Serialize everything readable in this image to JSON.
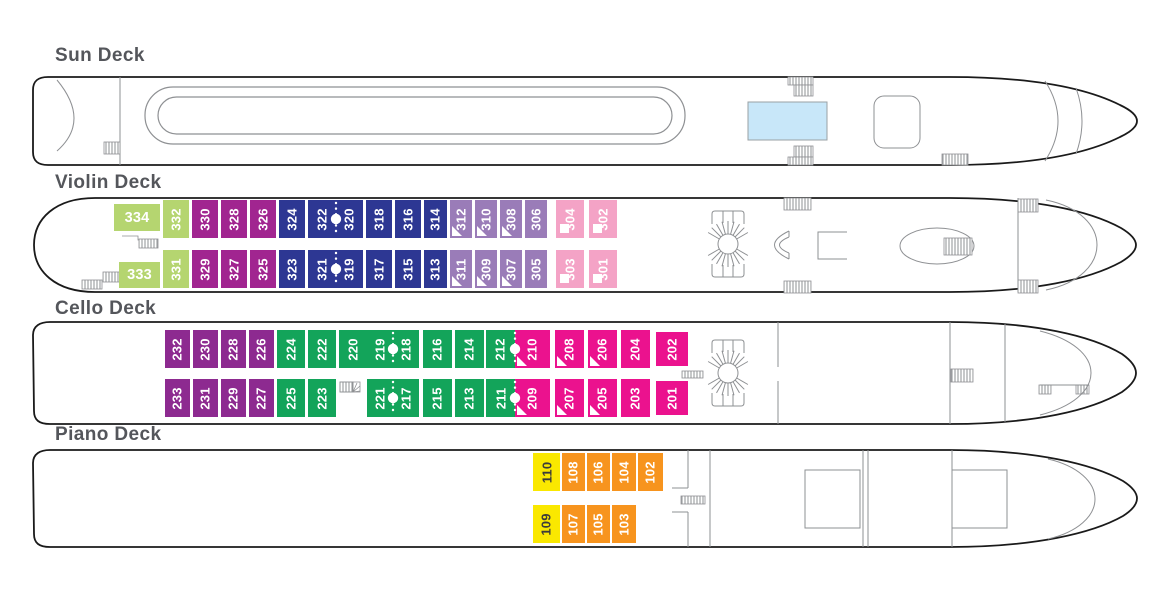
{
  "decks": [
    {
      "id": "sun",
      "title": "Sun Deck",
      "cabins": []
    },
    {
      "id": "violin",
      "title": "Violin Deck",
      "cabins": [
        {
          "num": "334",
          "x": 114,
          "y": 204,
          "w": 46,
          "h": 27,
          "color": "lightgreen",
          "icon": null,
          "orient": "h"
        },
        {
          "num": "332",
          "x": 163,
          "y": 200,
          "w": 26,
          "h": 38,
          "color": "lightgreen",
          "icon": null,
          "orient": "v"
        },
        {
          "num": "330",
          "x": 192,
          "y": 200,
          "w": 26,
          "h": 38,
          "color": "magenta",
          "icon": null,
          "orient": "v"
        },
        {
          "num": "328",
          "x": 221,
          "y": 200,
          "w": 26,
          "h": 38,
          "color": "magenta",
          "icon": null,
          "orient": "v"
        },
        {
          "num": "326",
          "x": 250,
          "y": 200,
          "w": 26,
          "h": 38,
          "color": "magenta",
          "icon": null,
          "orient": "v"
        },
        {
          "num": "324",
          "x": 279,
          "y": 200,
          "w": 26,
          "h": 38,
          "color": "navy",
          "icon": null,
          "orient": "v"
        },
        {
          "num": "322",
          "x": 308,
          "y": 200,
          "w": 28,
          "h": 38,
          "color": "navy",
          "icon": null,
          "orient": "v"
        },
        {
          "num": "320",
          "x": 336,
          "y": 200,
          "w": 27,
          "h": 38,
          "color": "navy",
          "icon": null,
          "orient": "v"
        },
        {
          "num": "318",
          "x": 366,
          "y": 200,
          "w": 26,
          "h": 38,
          "color": "navy",
          "icon": null,
          "orient": "v"
        },
        {
          "num": "316",
          "x": 395,
          "y": 200,
          "w": 26,
          "h": 38,
          "color": "navy",
          "icon": null,
          "orient": "v"
        },
        {
          "num": "314",
          "x": 424,
          "y": 200,
          "w": 23,
          "h": 38,
          "color": "navy",
          "icon": null,
          "orient": "v"
        },
        {
          "num": "312",
          "x": 450,
          "y": 200,
          "w": 22,
          "h": 38,
          "color": "lavender",
          "icon": "triangle",
          "orient": "v"
        },
        {
          "num": "310",
          "x": 475,
          "y": 200,
          "w": 22,
          "h": 38,
          "color": "lavender",
          "icon": "triangle",
          "orient": "v"
        },
        {
          "num": "308",
          "x": 500,
          "y": 200,
          "w": 22,
          "h": 38,
          "color": "lavender",
          "icon": "triangle",
          "orient": "v"
        },
        {
          "num": "306",
          "x": 525,
          "y": 200,
          "w": 22,
          "h": 38,
          "color": "lavender",
          "icon": null,
          "orient": "v"
        },
        {
          "num": "304",
          "x": 556,
          "y": 200,
          "w": 28,
          "h": 38,
          "color": "lightpink",
          "icon": "square",
          "orient": "v"
        },
        {
          "num": "302",
          "x": 589,
          "y": 200,
          "w": 28,
          "h": 38,
          "color": "lightpink",
          "icon": "square",
          "orient": "v"
        },
        {
          "num": "333",
          "x": 119,
          "y": 262,
          "w": 41,
          "h": 26,
          "color": "lightgreen",
          "icon": null,
          "orient": "h"
        },
        {
          "num": "331",
          "x": 163,
          "y": 250,
          "w": 26,
          "h": 38,
          "color": "lightgreen",
          "icon": null,
          "orient": "v"
        },
        {
          "num": "329",
          "x": 192,
          "y": 250,
          "w": 26,
          "h": 38,
          "color": "magenta",
          "icon": null,
          "orient": "v"
        },
        {
          "num": "327",
          "x": 221,
          "y": 250,
          "w": 26,
          "h": 38,
          "color": "magenta",
          "icon": null,
          "orient": "v"
        },
        {
          "num": "325",
          "x": 250,
          "y": 250,
          "w": 26,
          "h": 38,
          "color": "magenta",
          "icon": null,
          "orient": "v"
        },
        {
          "num": "323",
          "x": 279,
          "y": 250,
          "w": 26,
          "h": 38,
          "color": "navy",
          "icon": null,
          "orient": "v"
        },
        {
          "num": "321",
          "x": 308,
          "y": 250,
          "w": 28,
          "h": 38,
          "color": "navy",
          "icon": null,
          "orient": "v"
        },
        {
          "num": "319",
          "x": 336,
          "y": 250,
          "w": 27,
          "h": 38,
          "color": "navy",
          "icon": null,
          "orient": "v"
        },
        {
          "num": "317",
          "x": 366,
          "y": 250,
          "w": 26,
          "h": 38,
          "color": "navy",
          "icon": null,
          "orient": "v"
        },
        {
          "num": "315",
          "x": 395,
          "y": 250,
          "w": 26,
          "h": 38,
          "color": "navy",
          "icon": null,
          "orient": "v"
        },
        {
          "num": "313",
          "x": 424,
          "y": 250,
          "w": 23,
          "h": 38,
          "color": "navy",
          "icon": null,
          "orient": "v"
        },
        {
          "num": "311",
          "x": 450,
          "y": 250,
          "w": 22,
          "h": 38,
          "color": "lavender",
          "icon": "triangle",
          "orient": "v"
        },
        {
          "num": "309",
          "x": 475,
          "y": 250,
          "w": 22,
          "h": 38,
          "color": "lavender",
          "icon": "triangle",
          "orient": "v"
        },
        {
          "num": "307",
          "x": 500,
          "y": 250,
          "w": 22,
          "h": 38,
          "color": "lavender",
          "icon": "triangle",
          "orient": "v"
        },
        {
          "num": "305",
          "x": 525,
          "y": 250,
          "w": 22,
          "h": 38,
          "color": "lavender",
          "icon": null,
          "orient": "v"
        },
        {
          "num": "303",
          "x": 556,
          "y": 250,
          "w": 28,
          "h": 38,
          "color": "lightpink",
          "icon": "square",
          "orient": "v"
        },
        {
          "num": "301",
          "x": 589,
          "y": 250,
          "w": 28,
          "h": 38,
          "color": "lightpink",
          "icon": "square",
          "orient": "v"
        }
      ]
    },
    {
      "id": "cello",
      "title": "Cello Deck",
      "cabins": [
        {
          "num": "232",
          "x": 165,
          "y": 330,
          "w": 25,
          "h": 38,
          "color": "plum",
          "icon": null,
          "orient": "v"
        },
        {
          "num": "230",
          "x": 193,
          "y": 330,
          "w": 25,
          "h": 38,
          "color": "plum",
          "icon": null,
          "orient": "v"
        },
        {
          "num": "228",
          "x": 221,
          "y": 330,
          "w": 25,
          "h": 38,
          "color": "plum",
          "icon": null,
          "orient": "v"
        },
        {
          "num": "226",
          "x": 249,
          "y": 330,
          "w": 25,
          "h": 38,
          "color": "plum",
          "icon": null,
          "orient": "v"
        },
        {
          "num": "224",
          "x": 277,
          "y": 330,
          "w": 28,
          "h": 38,
          "color": "green",
          "icon": null,
          "orient": "v"
        },
        {
          "num": "222",
          "x": 308,
          "y": 330,
          "w": 28,
          "h": 38,
          "color": "green",
          "icon": null,
          "orient": "v"
        },
        {
          "num": "220",
          "x": 339,
          "y": 330,
          "w": 28,
          "h": 38,
          "color": "green",
          "icon": null,
          "orient": "v"
        },
        {
          "num": "219",
          "x": 367,
          "y": 330,
          "w": 26,
          "h": 38,
          "color": "green",
          "icon": null,
          "orient": "v"
        },
        {
          "num": "218",
          "x": 393,
          "y": 330,
          "w": 26,
          "h": 38,
          "color": "green",
          "icon": null,
          "orient": "v"
        },
        {
          "num": "216",
          "x": 423,
          "y": 330,
          "w": 29,
          "h": 38,
          "color": "green",
          "icon": null,
          "orient": "v"
        },
        {
          "num": "214",
          "x": 455,
          "y": 330,
          "w": 29,
          "h": 38,
          "color": "green",
          "icon": null,
          "orient": "v"
        },
        {
          "num": "212",
          "x": 486,
          "y": 330,
          "w": 29,
          "h": 38,
          "color": "green",
          "icon": null,
          "orient": "v"
        },
        {
          "num": "210",
          "x": 515,
          "y": 330,
          "w": 35,
          "h": 38,
          "color": "hotpink",
          "icon": "triangle",
          "orient": "v"
        },
        {
          "num": "208",
          "x": 555,
          "y": 330,
          "w": 29,
          "h": 38,
          "color": "hotpink",
          "icon": "triangle",
          "orient": "v"
        },
        {
          "num": "206",
          "x": 588,
          "y": 330,
          "w": 29,
          "h": 38,
          "color": "hotpink",
          "icon": "triangle",
          "orient": "v"
        },
        {
          "num": "204",
          "x": 621,
          "y": 330,
          "w": 29,
          "h": 38,
          "color": "hotpink",
          "icon": null,
          "orient": "v"
        },
        {
          "num": "202",
          "x": 656,
          "y": 332,
          "w": 32,
          "h": 34,
          "color": "hotpink",
          "icon": null,
          "orient": "v"
        },
        {
          "num": "233",
          "x": 165,
          "y": 379,
          "w": 25,
          "h": 38,
          "color": "plum",
          "icon": null,
          "orient": "v"
        },
        {
          "num": "231",
          "x": 193,
          "y": 379,
          "w": 25,
          "h": 38,
          "color": "plum",
          "icon": null,
          "orient": "v"
        },
        {
          "num": "229",
          "x": 221,
          "y": 379,
          "w": 25,
          "h": 38,
          "color": "plum",
          "icon": null,
          "orient": "v"
        },
        {
          "num": "227",
          "x": 249,
          "y": 379,
          "w": 25,
          "h": 38,
          "color": "plum",
          "icon": null,
          "orient": "v"
        },
        {
          "num": "225",
          "x": 277,
          "y": 379,
          "w": 28,
          "h": 38,
          "color": "green",
          "icon": null,
          "orient": "v"
        },
        {
          "num": "223",
          "x": 308,
          "y": 379,
          "w": 28,
          "h": 38,
          "color": "green",
          "icon": null,
          "orient": "v"
        },
        {
          "num": "221",
          "x": 367,
          "y": 379,
          "w": 26,
          "h": 38,
          "color": "green",
          "icon": null,
          "orient": "v"
        },
        {
          "num": "217",
          "x": 393,
          "y": 379,
          "w": 26,
          "h": 38,
          "color": "green",
          "icon": null,
          "orient": "v"
        },
        {
          "num": "215",
          "x": 423,
          "y": 379,
          "w": 29,
          "h": 38,
          "color": "green",
          "icon": null,
          "orient": "v"
        },
        {
          "num": "213",
          "x": 455,
          "y": 379,
          "w": 29,
          "h": 38,
          "color": "green",
          "icon": null,
          "orient": "v"
        },
        {
          "num": "211",
          "x": 486,
          "y": 379,
          "w": 29,
          "h": 38,
          "color": "green",
          "icon": null,
          "orient": "v"
        },
        {
          "num": "209",
          "x": 515,
          "y": 379,
          "w": 35,
          "h": 38,
          "color": "hotpink",
          "icon": "triangle",
          "orient": "v"
        },
        {
          "num": "207",
          "x": 555,
          "y": 379,
          "w": 29,
          "h": 38,
          "color": "hotpink",
          "icon": "triangle",
          "orient": "v"
        },
        {
          "num": "205",
          "x": 588,
          "y": 379,
          "w": 29,
          "h": 38,
          "color": "hotpink",
          "icon": "triangle",
          "orient": "v"
        },
        {
          "num": "203",
          "x": 621,
          "y": 379,
          "w": 29,
          "h": 38,
          "color": "hotpink",
          "icon": null,
          "orient": "v"
        },
        {
          "num": "201",
          "x": 656,
          "y": 381,
          "w": 32,
          "h": 34,
          "color": "hotpink",
          "icon": null,
          "orient": "v"
        }
      ]
    },
    {
      "id": "piano",
      "title": "Piano Deck",
      "cabins": [
        {
          "num": "110",
          "x": 533,
          "y": 453,
          "w": 27,
          "h": 38,
          "color": "yellow",
          "icon": null,
          "orient": "v"
        },
        {
          "num": "108",
          "x": 562,
          "y": 453,
          "w": 23,
          "h": 38,
          "color": "orange",
          "icon": null,
          "orient": "v"
        },
        {
          "num": "106",
          "x": 587,
          "y": 453,
          "w": 23,
          "h": 38,
          "color": "orange",
          "icon": null,
          "orient": "v"
        },
        {
          "num": "104",
          "x": 612,
          "y": 453,
          "w": 24,
          "h": 38,
          "color": "orange",
          "icon": null,
          "orient": "v"
        },
        {
          "num": "102",
          "x": 638,
          "y": 453,
          "w": 25,
          "h": 38,
          "color": "orange",
          "icon": null,
          "orient": "v"
        },
        {
          "num": "109",
          "x": 533,
          "y": 505,
          "w": 27,
          "h": 38,
          "color": "yellow",
          "icon": null,
          "orient": "v"
        },
        {
          "num": "107",
          "x": 562,
          "y": 505,
          "w": 23,
          "h": 38,
          "color": "orange",
          "icon": null,
          "orient": "v"
        },
        {
          "num": "105",
          "x": 587,
          "y": 505,
          "w": 23,
          "h": 38,
          "color": "orange",
          "icon": null,
          "orient": "v"
        },
        {
          "num": "103",
          "x": 612,
          "y": 505,
          "w": 24,
          "h": 38,
          "color": "orange",
          "icon": null,
          "orient": "v"
        }
      ]
    }
  ],
  "connected_pairs": [
    [
      "322",
      "320"
    ],
    [
      "321",
      "319"
    ],
    [
      "219",
      "218"
    ],
    [
      "221",
      "217"
    ],
    [
      "212",
      "210"
    ],
    [
      "211",
      "209"
    ]
  ],
  "colors": {
    "categories": {
      "lightgreen": {
        "bg": "#B5D570",
        "fg": "#FFFFFF"
      },
      "magenta": {
        "bg": "#A12590",
        "fg": "#FFFFFF"
      },
      "navy": {
        "bg": "#2D3793",
        "fg": "#FFFFFF"
      },
      "lavender": {
        "bg": "#9A7CB8",
        "fg": "#FFFFFF"
      },
      "lightpink": {
        "bg": "#F4A3C6",
        "fg": "#FFFFFF"
      },
      "plum": {
        "bg": "#8D2A90",
        "fg": "#FFFFFF"
      },
      "green": {
        "bg": "#13A45A",
        "fg": "#FFFFFF"
      },
      "hotpink": {
        "bg": "#EB128E",
        "fg": "#FFFFFF"
      },
      "yellow": {
        "bg": "#FAE800",
        "fg": "#3B3B3B"
      },
      "orange": {
        "bg": "#F7941E",
        "fg": "#FFFFFF"
      }
    },
    "pool": "#C8E7F9",
    "hull_outline": "#1A1A1A",
    "detail_gray": "#8E9093",
    "title_gray": "#54565B"
  }
}
